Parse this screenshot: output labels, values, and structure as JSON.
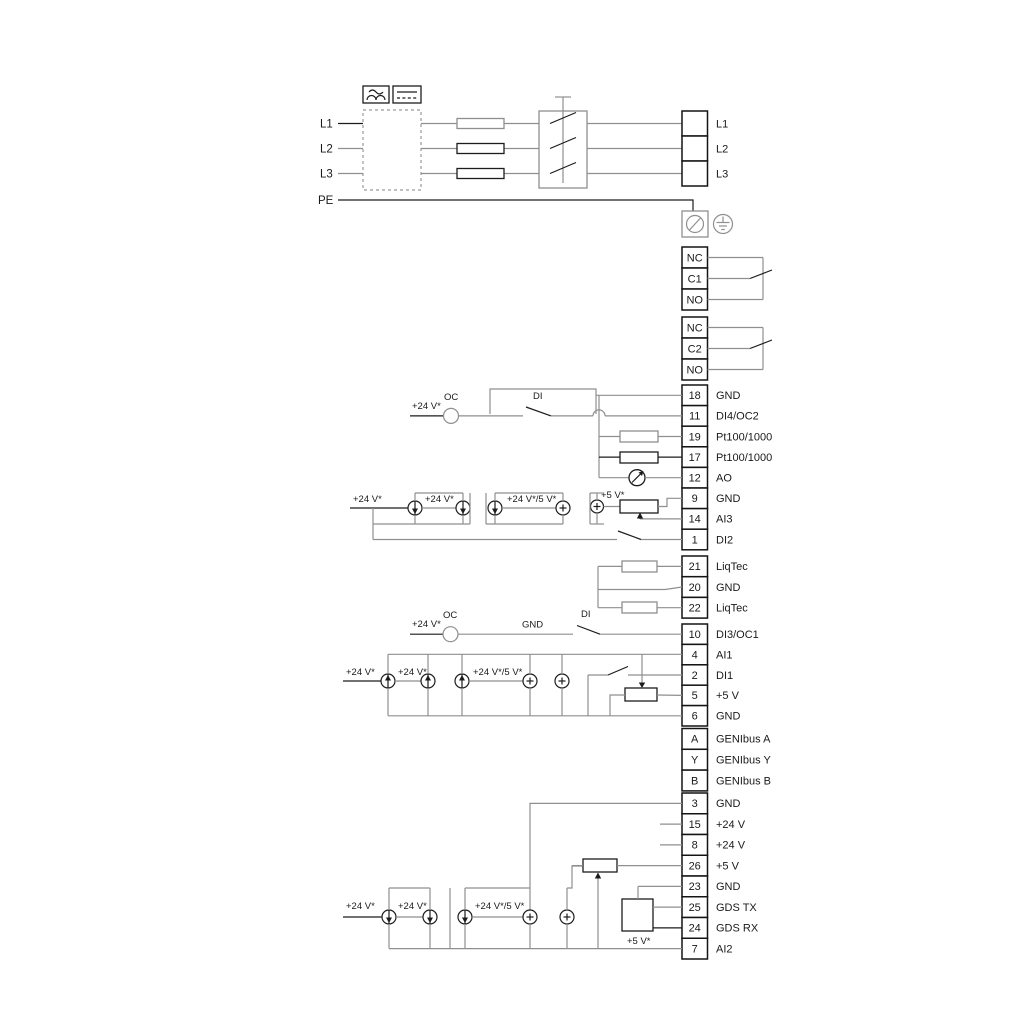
{
  "colors": {
    "wire_gray": "#8f8f8f",
    "ink_black": "#1c1c1c",
    "background": "#ffffff"
  },
  "mains_in": {
    "l1": "L1",
    "l2": "L2",
    "l3": "L3",
    "pe": "PE"
  },
  "mains_out": {
    "l1": "L1",
    "l2": "L2",
    "l3": "L3"
  },
  "relay1": {
    "nc": "NC",
    "c": "C1",
    "no": "NO"
  },
  "relay2": {
    "nc": "NC",
    "c": "C2",
    "no": "NO"
  },
  "io1": {
    "rows": [
      {
        "num": "18",
        "label": "GND"
      },
      {
        "num": "11",
        "label": "DI4/OC2"
      },
      {
        "num": "19",
        "label": "Pt100/1000"
      },
      {
        "num": "17",
        "label": "Pt100/1000"
      },
      {
        "num": "12",
        "label": "AO"
      },
      {
        "num": "9",
        "label": "GND"
      },
      {
        "num": "14",
        "label": "AI3"
      },
      {
        "num": "1",
        "label": "DI2"
      }
    ]
  },
  "liqtec": {
    "rows": [
      {
        "num": "21",
        "label": "LiqTec"
      },
      {
        "num": "20",
        "label": "GND"
      },
      {
        "num": "22",
        "label": "LiqTec"
      }
    ]
  },
  "io2": {
    "rows": [
      {
        "num": "10",
        "label": "DI3/OC1"
      },
      {
        "num": "4",
        "label": "AI1"
      },
      {
        "num": "2",
        "label": "DI1"
      },
      {
        "num": "5",
        "label": "+5 V"
      },
      {
        "num": "6",
        "label": "GND"
      }
    ]
  },
  "genibus": {
    "rows": [
      {
        "num": "A",
        "label": "GENIbus A"
      },
      {
        "num": "Y",
        "label": "GENIbus Y"
      },
      {
        "num": "B",
        "label": "GENIbus B"
      }
    ]
  },
  "io3": {
    "rows": [
      {
        "num": "3",
        "label": "GND"
      },
      {
        "num": "15",
        "label": "+24 V"
      },
      {
        "num": "8",
        "label": "+24 V"
      },
      {
        "num": "26",
        "label": "+5 V"
      },
      {
        "num": "23",
        "label": "GND"
      },
      {
        "num": "25",
        "label": "GDS TX"
      },
      {
        "num": "24",
        "label": "GDS RX"
      },
      {
        "num": "7",
        "label": "AI2"
      }
    ]
  },
  "ann": {
    "v24": "+24 V*",
    "v24v5": "+24 V*/5 V*",
    "v5": "+5 V*",
    "oc": "OC",
    "di": "DI",
    "gnd": "GND"
  }
}
